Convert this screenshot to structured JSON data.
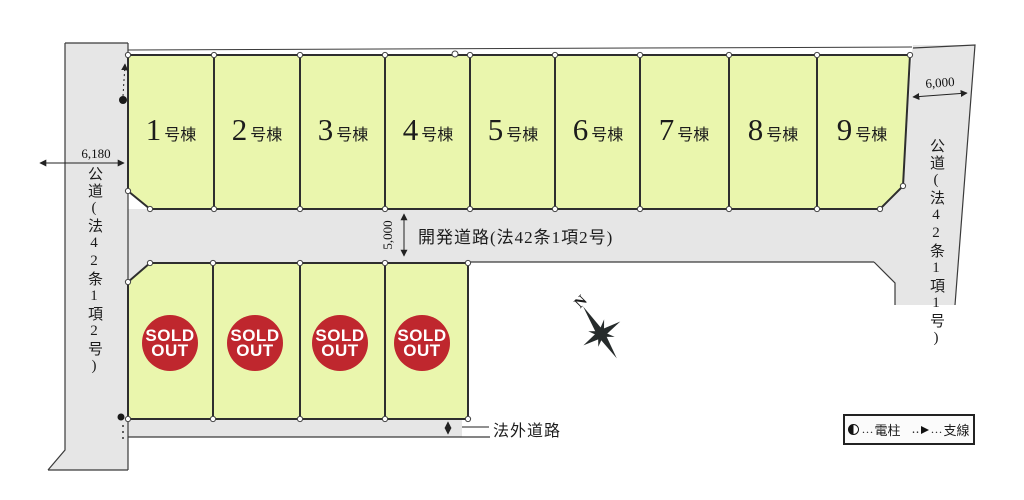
{
  "map": {
    "lots": {
      "suffix": "号棟",
      "items": [
        {
          "num": "1"
        },
        {
          "num": "2"
        },
        {
          "num": "3"
        },
        {
          "num": "4"
        },
        {
          "num": "5"
        },
        {
          "num": "6"
        },
        {
          "num": "7"
        },
        {
          "num": "8"
        },
        {
          "num": "9"
        }
      ]
    },
    "sold": {
      "count": 4,
      "badge_line1": "SOLD",
      "badge_line2": "OUT"
    },
    "roads": {
      "left": {
        "label": "公道(法42条1項2号)",
        "dimension": "6,180"
      },
      "right": {
        "label": "公道(法42条1項1号)",
        "dimension": "6,000"
      },
      "development": {
        "label": "開発道路(法42条1項2号)",
        "dimension": "5,000"
      },
      "outside": {
        "label": "法外道路"
      }
    },
    "compass": {
      "label": "N"
    },
    "legend": {
      "pole_dots": "…",
      "pole_label": "電柱",
      "wire_dots_before": "‥",
      "wire_dots_after": "…",
      "wire_label": "支線"
    },
    "colors": {
      "lot_fill": "#eaf6ad",
      "road_fill": "#e6e6e6",
      "outline": "#2e2e2e",
      "sold_red": "#bf272e",
      "sold_text": "#ffffff"
    }
  }
}
